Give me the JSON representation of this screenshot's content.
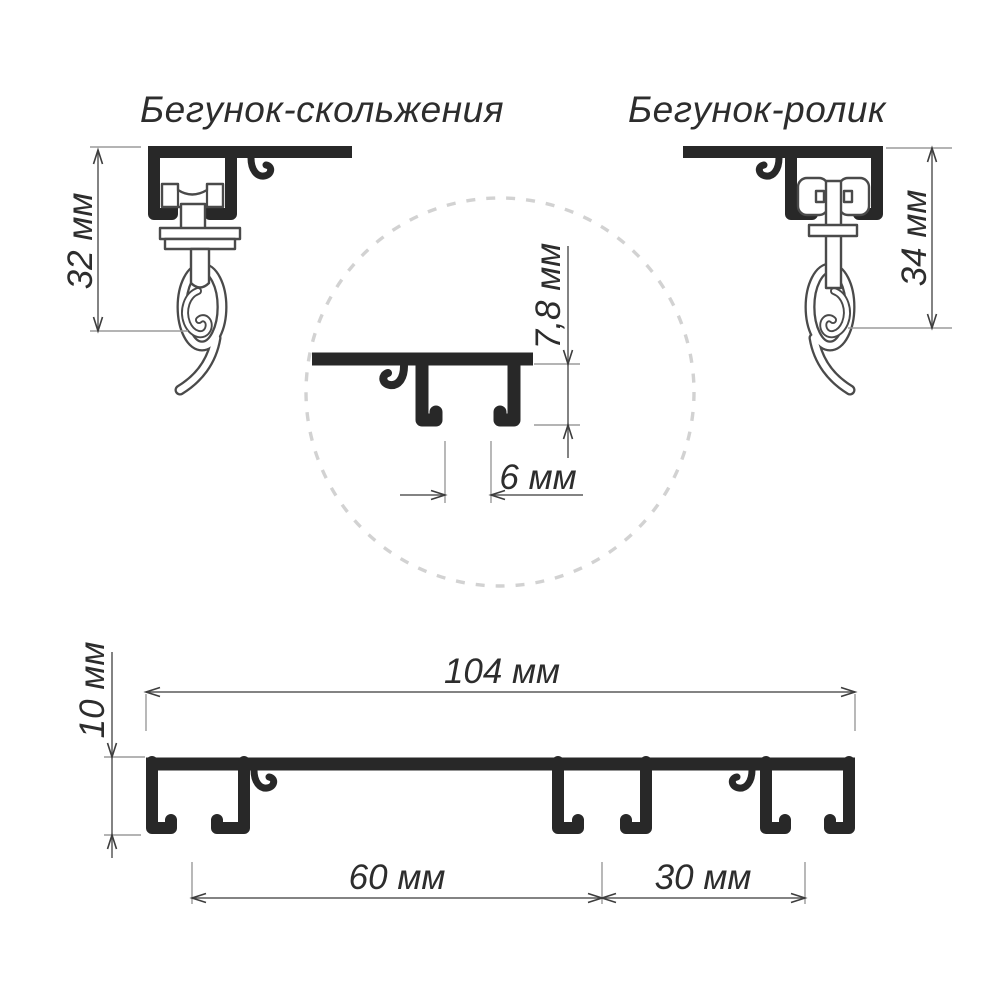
{
  "diagram": {
    "type": "technical-drawing",
    "subject": "curtain rail profile with runners",
    "titles": {
      "left": "Бегунок-скольжения",
      "right": "Бегунок-ролик"
    },
    "dimensions": {
      "slider_runner_height": "32 мм",
      "roller_runner_height": "34 мм",
      "channel_inner_height": "7,8 мм",
      "channel_slot_width": "6 мм",
      "profile_total_width": "104 мм",
      "profile_height": "10 мм",
      "channel_spacing_left": "60 мм",
      "channel_spacing_right": "30 мм"
    },
    "colors": {
      "bg": "#ffffff",
      "profile": "#282828",
      "outline": "#4a4a4a",
      "dim": "#5a5a5a",
      "tick": "#9b9b9b",
      "arrow": "#3d3d3d",
      "circle": "#d2d2d2",
      "text": "#2d2d2d"
    }
  }
}
